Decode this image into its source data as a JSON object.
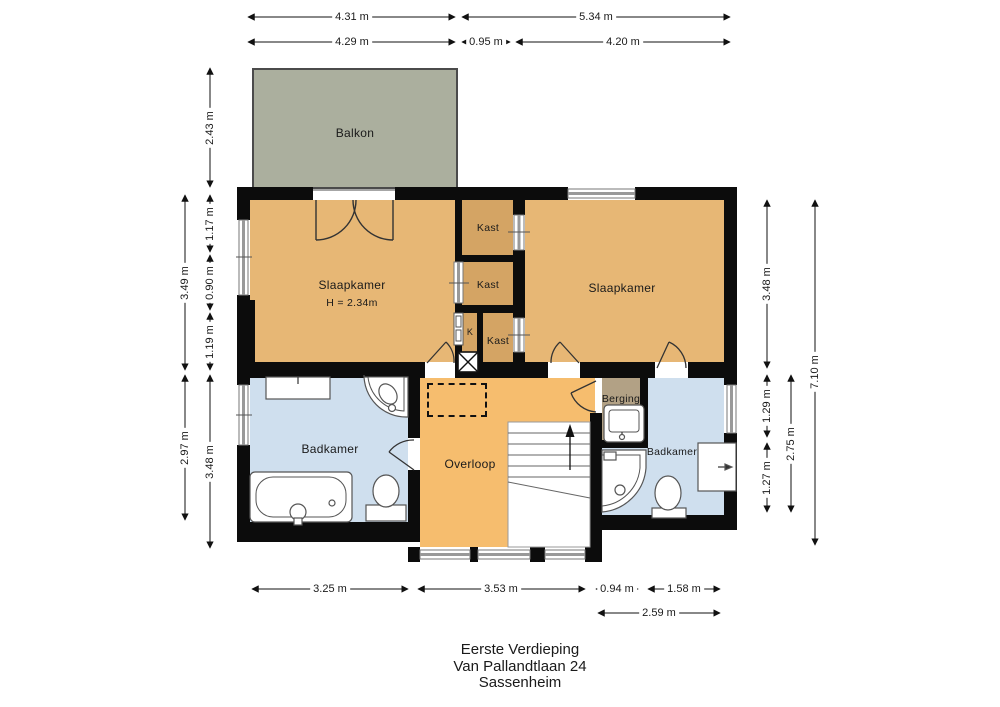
{
  "title": {
    "line1": "Eerste Verdieping",
    "line2": "Van Pallandtlaan 24",
    "line3": "Sassenheim"
  },
  "rooms": {
    "balkon": {
      "label": "Balkon"
    },
    "slaapkamer_left": {
      "label": "Slaapkamer",
      "height_note": "H = 2.34m"
    },
    "slaapkamer_right": {
      "label": "Slaapkamer"
    },
    "kast_top": {
      "label": "Kast"
    },
    "kast_middle": {
      "label": "Kast"
    },
    "kast_bottom": {
      "label": "Kast"
    },
    "k_closet": {
      "label": "K"
    },
    "badkamer_left": {
      "label": "Badkamer"
    },
    "badkamer_right": {
      "label": "Badkamer"
    },
    "overloop": {
      "label": "Overloop"
    },
    "berging": {
      "label": "Berging"
    }
  },
  "dimensions": {
    "top_row1": {
      "left": "4.31 m",
      "right": "5.34 m"
    },
    "top_row2": {
      "left": "4.29 m",
      "mid": "0.95 m",
      "right": "4.20 m"
    },
    "left_outer": {
      "top": "3.49 m",
      "bottom": "2.97 m"
    },
    "left_inner": {
      "balcony": "2.43 m",
      "a": "1.17 m",
      "b": "0.90 m",
      "c": "1.19 m",
      "d": "3.48 m"
    },
    "right_inner": {
      "top": "3.48 m",
      "mid": "1.29 m",
      "bottom": "1.27 m"
    },
    "right_mid": {
      "value": "2.75 m"
    },
    "right_outer": {
      "value": "7.10 m"
    },
    "bottom_row1": {
      "a": "3.25 m",
      "b": "3.53 m",
      "c": "0.94 m",
      "d": "1.58 m"
    },
    "bottom_row2": {
      "value": "2.59 m"
    }
  },
  "colors": {
    "bedroom_tan": "#e7b775",
    "closet_tan": "#d4a464",
    "landing_orange": "#f6bd6e",
    "bathroom_blue": "#cfdfee",
    "storage_brown": "#b2a185",
    "balcony_gray": "#abaf9e",
    "wall_black": "#0c0c0c"
  }
}
